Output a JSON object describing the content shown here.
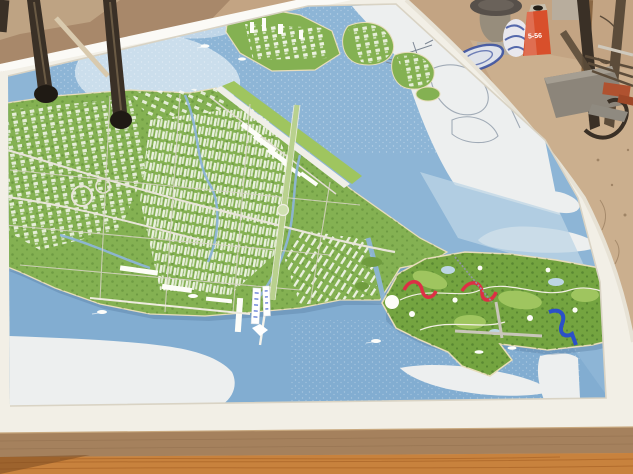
{
  "image": {
    "type": "photograph",
    "subject": "Architectural scale model (maquette) of a coastal urban master plan with an airport runway, dense white building districts, canals, and a golf / theme-park island, displayed in a white tray on a wooden table",
    "setting": "workshop floor with a metal stand, stone pedestals, blue-white porcelain, a lubricant can and scattered building materials"
  },
  "labels": {
    "lubricant_can": "5-56"
  },
  "counts": {
    "boats": 7,
    "bridge_signs": 2
  },
  "objects": [
    "urban-planning-scale-model",
    "white-display-tray",
    "water-basin",
    "city-districts",
    "airport-runway",
    "highway-interchange",
    "central-boulevard",
    "golf-theme-park-island",
    "roller-coaster",
    "water-slide",
    "pier",
    "model-boats",
    "bridge-signs",
    "unpainted-land-outlines",
    "workshop-floor",
    "foreground-stand-legs",
    "metal-stool",
    "stone-pedestals",
    "porcelain-vase",
    "porcelain-plate",
    "lubricant-can",
    "red-bricks",
    "metal-bars",
    "mdf-board-edge",
    "wooden-table-edge"
  ],
  "colors": {
    "floor_tan": "#c3a483",
    "floor_dirt": "#a8886a",
    "floor_light": "#d4bd9c",
    "metal_dark": "#3a3026",
    "metal_mid": "#5c4c3a",
    "rubber_black": "#1f1a14",
    "stone_grey": "#b7aea0",
    "stone_dark": "#978d7c",
    "porcelain_white": "#e9e8ee",
    "porcelain_blue": "#3c52a0",
    "can_red": "#d84f2b",
    "wood_stick": "#8a6743",
    "brick_red": "#b05230",
    "tray_white": "#f2efe6",
    "tray_bright": "#fbfaf6",
    "tray_shadow": "#d9d3c4",
    "tray_side": "#e7e2d5",
    "water": "#8db5d6",
    "water_deep": "#7fabd0",
    "water_pale": "#bdd6e5",
    "land_green": "#84b152",
    "golf_green": "#74a440",
    "land_dark": "#4d7a2c",
    "fairway": "#9fc55f",
    "sand": "#e7ddbb",
    "building_white": "#fdfdf8",
    "building_shadow": "#c9c4b4",
    "road": "#e8e5d9",
    "road_minor": "#d8d4c6",
    "boulevard": "#b9d18e",
    "unpainted": "#edefef",
    "outline_grey": "#8e9aa8",
    "coaster_red": "#dd2f45",
    "slide_blue": "#2b50c8",
    "pier_grey": "#c9c6ba",
    "mdf": "#a5815d",
    "mdf_line": "#93714f",
    "wood": "#c8823d",
    "wood_grain": "#a96427",
    "wood_dark": "#7a4a20",
    "boat_white": "#fdfdfa",
    "sign_blue": "#2b50c8"
  }
}
